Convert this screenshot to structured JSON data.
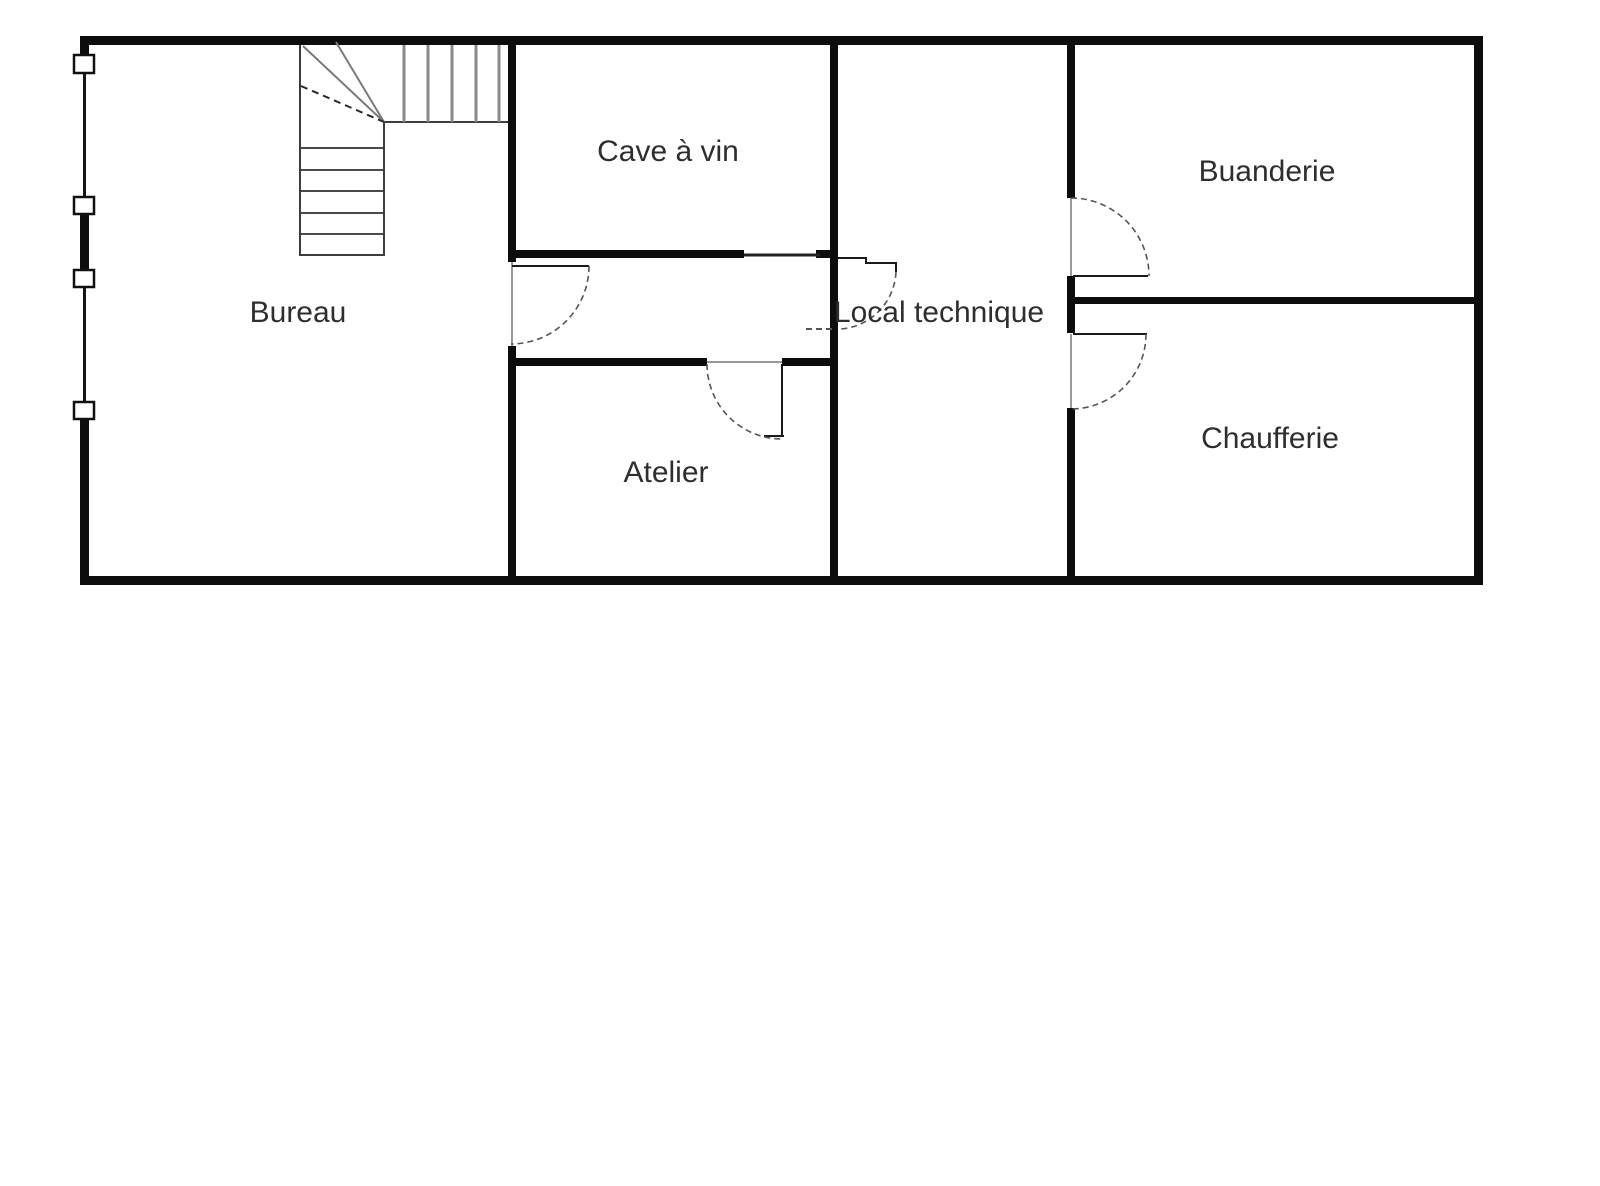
{
  "floorplan": {
    "colors": {
      "wall": "#0d0d0d",
      "opening": "#999999",
      "door": "#1a1a1a",
      "arc": "#555555",
      "stair_edge": "#3c3c3c",
      "stair_tread_dark": "#4a4a4a",
      "stair_tread_gray": "#8a8a8a",
      "stair_diag": "#7a7a7a",
      "label_text": "#2e2e2e",
      "window_border": "#111111",
      "background": "#ffffff"
    },
    "rooms": [
      {
        "id": "bureau",
        "label": "Bureau",
        "cx": 298,
        "cy": 311
      },
      {
        "id": "cave-a-vin",
        "label": "Cave à vin",
        "cx": 668,
        "cy": 150
      },
      {
        "id": "atelier",
        "label": "Atelier",
        "cx": 666,
        "cy": 471
      },
      {
        "id": "local-technique",
        "label": "Local technique",
        "cx": 939,
        "cy": 311
      },
      {
        "id": "buanderie",
        "label": "Buanderie",
        "cx": 1267,
        "cy": 170
      },
      {
        "id": "chaufferie",
        "label": "Chaufferie",
        "cx": 1270,
        "cy": 437
      }
    ],
    "walls": {
      "rects": [
        {
          "name": "outer-wall-top",
          "x": 80,
          "y": 36,
          "w": 1403,
          "h": 9
        },
        {
          "name": "outer-wall-bottom",
          "x": 80,
          "y": 576,
          "w": 1403,
          "h": 9
        },
        {
          "name": "outer-wall-right",
          "x": 1474,
          "y": 36,
          "w": 9,
          "h": 549
        },
        {
          "name": "outer-wall-left-seg1",
          "x": 80,
          "y": 36,
          "w": 9,
          "h": 21
        },
        {
          "name": "outer-wall-left-seg2",
          "x": 80,
          "y": 214,
          "w": 9,
          "h": 57
        },
        {
          "name": "outer-wall-left-seg3",
          "x": 80,
          "y": 419,
          "w": 9,
          "h": 166
        },
        {
          "name": "wall-bureau-cave-upper",
          "x": 508,
          "y": 45,
          "w": 8,
          "h": 217
        },
        {
          "name": "wall-bureau-atelier-lower",
          "x": 508,
          "y": 346,
          "w": 8,
          "h": 230
        },
        {
          "name": "wall-local-west",
          "x": 830,
          "y": 45,
          "w": 8,
          "h": 531
        },
        {
          "name": "wall-local-east-seg1",
          "x": 1067,
          "y": 45,
          "w": 8,
          "h": 153
        },
        {
          "name": "wall-local-east-seg2",
          "x": 1067,
          "y": 276,
          "w": 8,
          "h": 57
        },
        {
          "name": "wall-local-east-seg3",
          "x": 1067,
          "y": 408,
          "w": 8,
          "h": 168
        },
        {
          "name": "wall-cave-bottom",
          "x": 516,
          "y": 250,
          "w": 228,
          "h": 8
        },
        {
          "name": "wall-cave-bottom-knob",
          "x": 816,
          "y": 250,
          "w": 14,
          "h": 8
        },
        {
          "name": "wall-atelier-top-west",
          "x": 516,
          "y": 358,
          "w": 191,
          "h": 8
        },
        {
          "name": "wall-atelier-top-east",
          "x": 782,
          "y": 358,
          "w": 48,
          "h": 8
        },
        {
          "name": "wall-buanderie-chaufferie",
          "x": 1075,
          "y": 297,
          "w": 399,
          "h": 7
        }
      ]
    },
    "lines": [
      {
        "name": "left-wall-thin-seg1",
        "x1": 84.5,
        "y1": 73,
        "x2": 84.5,
        "y2": 198,
        "w": 3,
        "c": "#161616"
      },
      {
        "name": "left-wall-thin-seg2",
        "x1": 84.5,
        "y1": 287,
        "x2": 84.5,
        "y2": 403,
        "w": 3,
        "c": "#161616"
      },
      {
        "name": "opening-line-bureau-door",
        "x1": 512,
        "y1": 262,
        "x2": 512,
        "y2": 346,
        "w": 2,
        "c": "#999999"
      },
      {
        "name": "opening-line-buanderie-door",
        "x1": 1071,
        "y1": 198,
        "x2": 1071,
        "y2": 276,
        "w": 2,
        "c": "#999999"
      },
      {
        "name": "opening-line-chaufferie-door",
        "x1": 1071,
        "y1": 334,
        "x2": 1071,
        "y2": 408,
        "w": 2,
        "c": "#999999"
      },
      {
        "name": "thin-wall-corridor-top",
        "x1": 744,
        "y1": 255,
        "x2": 820,
        "y2": 255,
        "w": 3,
        "c": "#222222"
      },
      {
        "name": "opening-line-atelier-door",
        "x1": 707,
        "y1": 362,
        "x2": 782,
        "y2": 362,
        "w": 2,
        "c": "#999999"
      },
      {
        "name": "stair-left-edge",
        "x1": 300,
        "y1": 45,
        "x2": 300,
        "y2": 256,
        "w": 2,
        "c": "#3c3c3c"
      },
      {
        "name": "stair-lower-right-edge",
        "x1": 384,
        "y1": 122,
        "x2": 384,
        "y2": 256,
        "w": 2,
        "c": "#3c3c3c"
      },
      {
        "name": "stair-lower-bottom-edge",
        "x1": 300,
        "y1": 255,
        "x2": 384,
        "y2": 255,
        "w": 2,
        "c": "#3c3c3c"
      },
      {
        "name": "stair-upper-bottom-edge",
        "x1": 384,
        "y1": 122,
        "x2": 508,
        "y2": 122,
        "w": 2,
        "c": "#3c3c3c"
      },
      {
        "name": "stair-tread-lower-1",
        "x1": 301,
        "y1": 148,
        "x2": 383,
        "y2": 148,
        "w": 2,
        "c": "#4a4a4a"
      },
      {
        "name": "stair-tread-lower-2",
        "x1": 301,
        "y1": 170,
        "x2": 383,
        "y2": 170,
        "w": 2,
        "c": "#4a4a4a"
      },
      {
        "name": "stair-tread-lower-3",
        "x1": 301,
        "y1": 191,
        "x2": 383,
        "y2": 191,
        "w": 2,
        "c": "#4a4a4a"
      },
      {
        "name": "stair-tread-lower-4",
        "x1": 301,
        "y1": 213,
        "x2": 383,
        "y2": 213,
        "w": 2,
        "c": "#4a4a4a"
      },
      {
        "name": "stair-tread-lower-5",
        "x1": 301,
        "y1": 234,
        "x2": 383,
        "y2": 234,
        "w": 2,
        "c": "#4a4a4a"
      },
      {
        "name": "stair-tread-upper-1",
        "x1": 404,
        "y1": 45,
        "x2": 404,
        "y2": 122,
        "w": 3,
        "c": "#8a8a8a"
      },
      {
        "name": "stair-tread-upper-2",
        "x1": 428,
        "y1": 45,
        "x2": 428,
        "y2": 122,
        "w": 3,
        "c": "#8a8a8a"
      },
      {
        "name": "stair-tread-upper-3",
        "x1": 452,
        "y1": 45,
        "x2": 452,
        "y2": 122,
        "w": 3,
        "c": "#8a8a8a"
      },
      {
        "name": "stair-tread-upper-4",
        "x1": 476,
        "y1": 45,
        "x2": 476,
        "y2": 122,
        "w": 3,
        "c": "#8a8a8a"
      },
      {
        "name": "stair-tread-upper-5",
        "x1": 499,
        "y1": 45,
        "x2": 499,
        "y2": 122,
        "w": 3,
        "c": "#8a8a8a"
      },
      {
        "name": "stair-winder-diagonal-1",
        "x1": 303,
        "y1": 46,
        "x2": 384,
        "y2": 122,
        "w": 2,
        "c": "#7a7a7a"
      },
      {
        "name": "stair-winder-diagonal-2",
        "x1": 336,
        "y1": 42,
        "x2": 384,
        "y2": 122,
        "w": 2,
        "c": "#7a7a7a"
      },
      {
        "name": "stair-winder-diagonal-dashed",
        "x1": 301,
        "y1": 86,
        "x2": 384,
        "y2": 122,
        "w": 2,
        "c": "#2a2a2a",
        "dash": "7 5"
      },
      {
        "name": "door-local-swing-tick",
        "x1": 806,
        "y1": 329,
        "x2": 836,
        "y2": 329,
        "w": 2,
        "c": "#555555",
        "dash": "6 4"
      }
    ],
    "windows": [
      {
        "name": "window-left-1",
        "x": 74,
        "y": 55,
        "w": 20,
        "h": 18
      },
      {
        "name": "window-left-2",
        "x": 74,
        "y": 197,
        "w": 20,
        "h": 17
      },
      {
        "name": "window-left-3",
        "x": 74,
        "y": 270,
        "w": 20,
        "h": 17
      },
      {
        "name": "window-left-4",
        "x": 74,
        "y": 402,
        "w": 20,
        "h": 17
      }
    ],
    "doors": {
      "leaves": [
        {
          "name": "door-leaf-bureau",
          "points": "512,266 589,266"
        },
        {
          "name": "door-leaf-atelier",
          "points": "782,364 782,437"
        },
        {
          "name": "door-leaf-atelier-tick",
          "points": "764,436 784,436"
        },
        {
          "name": "door-leaf-local",
          "points": "838,258 866,258 866,263 896,263 896,272"
        },
        {
          "name": "door-leaf-buanderie",
          "points": "1073,276 1148,276"
        },
        {
          "name": "door-leaf-chaufferie",
          "points": "1073,334 1147,334"
        }
      ],
      "arcs": [
        {
          "name": "door-arc-bureau",
          "path": "M 589 266 A 78 78 0 0 1 511 344"
        },
        {
          "name": "door-arc-atelier",
          "path": "M 707 364 A 75 75 0 0 0 782 439"
        },
        {
          "name": "door-arc-local",
          "path": "M 896 272 A 60 60 0 0 1 841 329"
        },
        {
          "name": "door-arc-buanderie",
          "path": "M 1071 198 A 78 78 0 0 1 1149 276"
        },
        {
          "name": "door-arc-chaufferie",
          "path": "M 1146 334 A 75 75 0 0 1 1071 409"
        }
      ]
    }
  }
}
